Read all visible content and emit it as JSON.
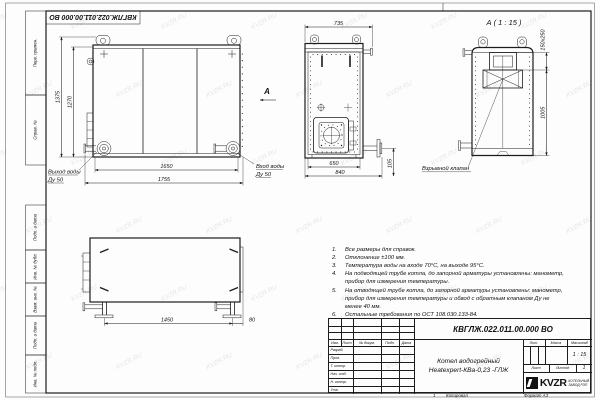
{
  "watermark": {
    "text": "KVZR.RU"
  },
  "frame": {
    "designation_top": "КВГЛЖ.022.011.00.000 ВО",
    "margin_labels": {
      "perv_primen": "Перв. примен.",
      "sprav_no": "Справ. №",
      "podp_data1": "Подп. и дата",
      "inv_dubl": "Инв. № дубл.",
      "vzam_inv": "Взам. инв. №",
      "podp_data2": "Подп. и дата",
      "inv_podl": "Инв. № подл."
    },
    "bottom": {
      "sheet_mark": "1",
      "copied": "Копировал",
      "format": "Формат А3"
    }
  },
  "views": {
    "front": {
      "dim_height_outer": "1375",
      "dim_height_inner": "1270",
      "dim_width_inner": "1650",
      "dim_width_outer": "1755",
      "label_outlet_line1": "Выход воды",
      "label_outlet_line2": "Ду 50",
      "label_inlet_line1": "Вход воды",
      "label_inlet_line2": "Ду 50",
      "view_arrow_label": "А"
    },
    "side": {
      "dim_top": "735",
      "dim_bottom_inner": "650",
      "dim_bottom_outer": "840",
      "dim_pipe_height": "105"
    },
    "detail_a": {
      "title": "А ( 1 : 15 )",
      "dim_valve": "150x250",
      "dim_height": "1005",
      "label_valve": "Взрывной клапан"
    },
    "top_view": {
      "dim_span": "1450",
      "dim_offset": "80"
    }
  },
  "notes": {
    "items": [
      {
        "n": "1.",
        "t": "Все размеры для справок."
      },
      {
        "n": "2.",
        "t": "Отклонение ±100 мм."
      },
      {
        "n": "3.",
        "t": "Температура воды на входе 70°С, на выходе 95°С."
      },
      {
        "n": "4.",
        "t": "На подводящей трубе котла, до запорной арматуры установлены: манометр, прибор для измерения температуры."
      },
      {
        "n": "5.",
        "t": "На отводящей трубе котла, до запорной арматуры установлены: манометр, прибор для измерения температуры и обвод с обратным клапаном Ду не менее 40 мм."
      },
      {
        "n": "6.",
        "t": "Остальные требования по ОСТ 108.030.133-84."
      }
    ]
  },
  "title_block": {
    "designation": "КВГЛЖ.022.011.00.000 ВО",
    "name_line1": "Котел водогрейный",
    "name_line2": "Heatexpert-КВа-0,23 -ГЛЖ",
    "headers": {
      "lit": "Лит.",
      "mass": "Масса",
      "scale": "Масштаб",
      "scale_value": "1 : 15",
      "sheet": "Лист",
      "sheets": "Листов",
      "sheets_value": "1"
    },
    "rows": {
      "izm": "Изм.",
      "list": "Лист",
      "doc": "№ докум.",
      "podp": "Подп.",
      "data": "Дата",
      "razrab": "Разраб.",
      "prov": "Пров.",
      "tkontr": "Т. контр.",
      "nach": "Нач. отд.",
      "nkontr": "Н. контр.",
      "utv": "Утв."
    },
    "company": {
      "logo": "KVZR",
      "line1": "КОТЕЛЬНЫЙ",
      "line2": "ЗАВОД РЭП"
    }
  },
  "colors": {
    "line": "#1c1c1c",
    "paper": "#fdfdfd",
    "watermark_gray": "#c9c9cc"
  }
}
